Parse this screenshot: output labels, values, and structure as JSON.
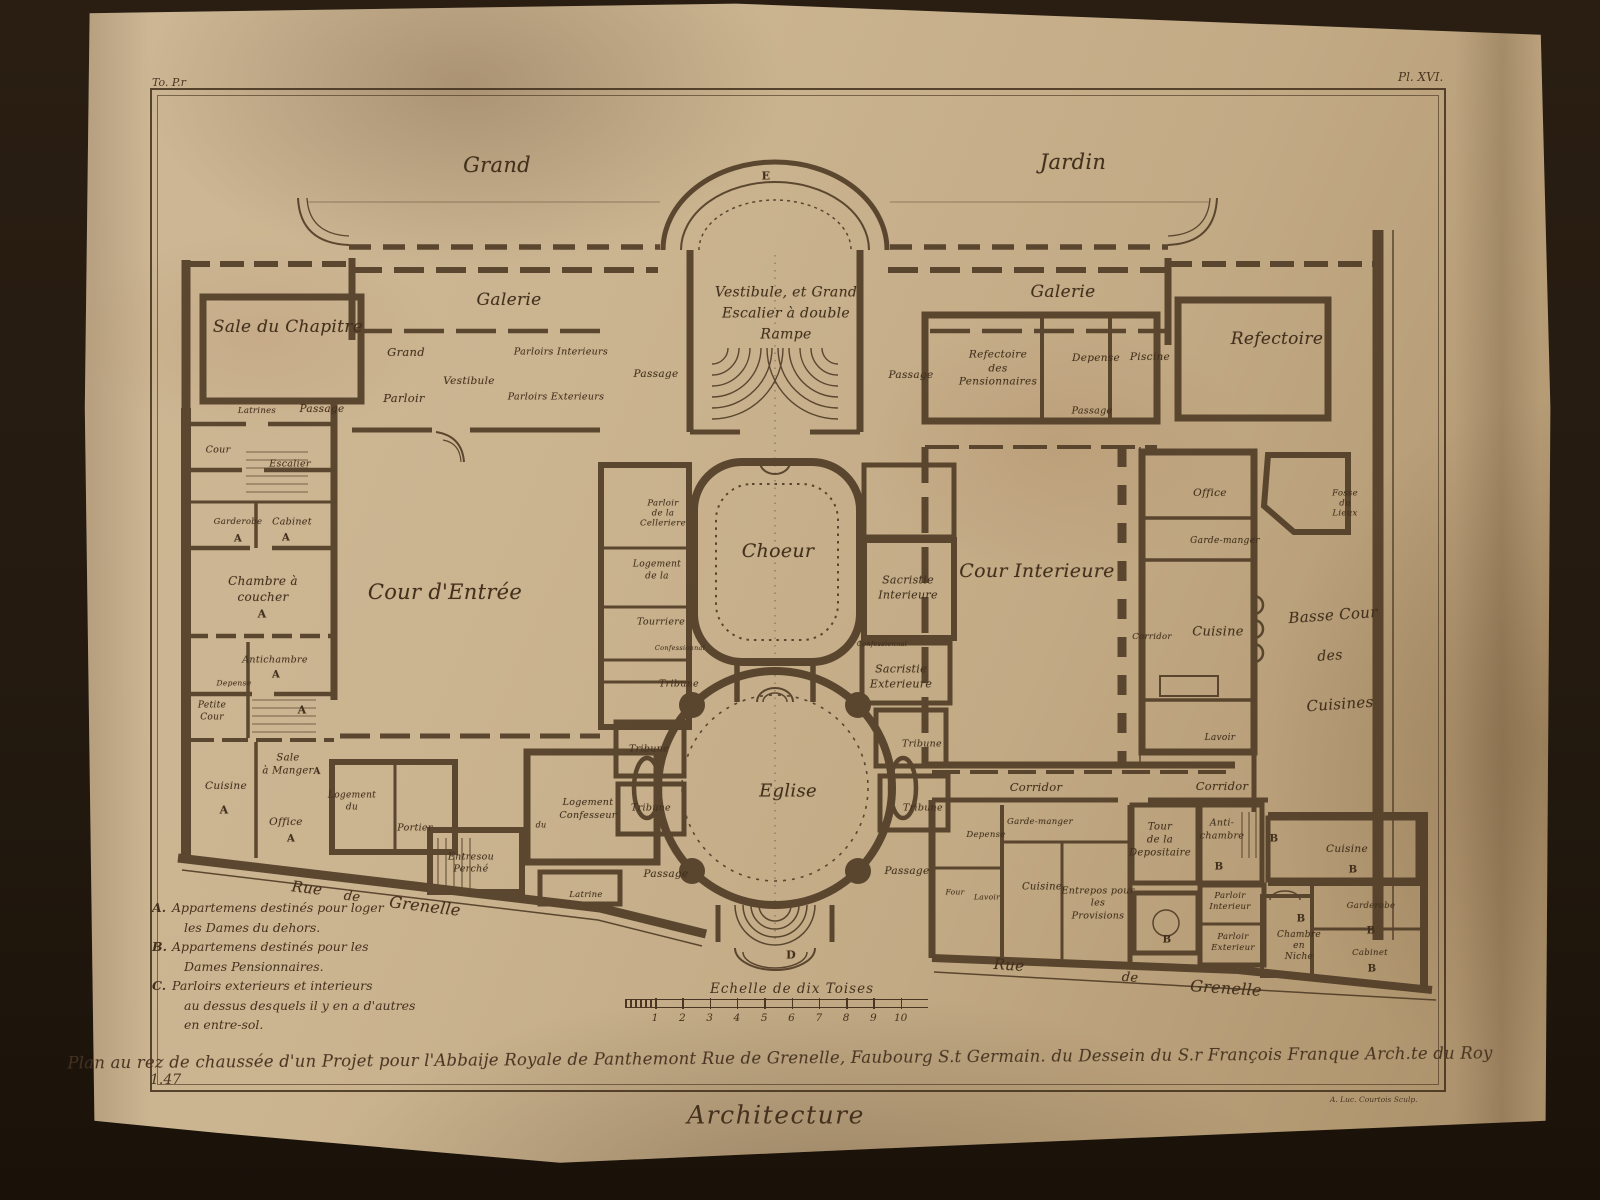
{
  "plate": {
    "tome_ref": "To. P.r",
    "plate_no": "Pl. XVI.",
    "page_no": "1.47",
    "section_title": "Architecture",
    "engraver_credit": "A. Luc. Courtois Sculp.",
    "caption": "Plan au rez de chaussée d'un Projet pour l'Abbaije Royale de Panthemont Rue de Grenelle, Faubourg S.t Germain. du Dessein du S.r François Franque Arch.te du Roy",
    "ink_color": "#4e3a25",
    "paper_color": "#c8b08c"
  },
  "scale_bar": {
    "label": "Echelle de dix Toises",
    "ticks": [
      "1",
      "2",
      "3",
      "4",
      "5",
      "6",
      "7",
      "8",
      "9",
      "10"
    ]
  },
  "legend": {
    "items": [
      {
        "key": "A.",
        "lines": [
          "Appartemens destinés pour loger",
          "les Dames du dehors."
        ]
      },
      {
        "key": "B.",
        "lines": [
          "Appartemens destinés pour les",
          "Dames Pensionnaires."
        ]
      },
      {
        "key": "C.",
        "lines": [
          "Parloirs exterieurs et interieurs",
          "au dessus desquels il y en a d'autres",
          "en entre-sol."
        ]
      }
    ]
  },
  "plan_labels": [
    {
      "text": "Grand",
      "x": 497,
      "y": 165,
      "fs": 21
    },
    {
      "text": "Jardin",
      "x": 1073,
      "y": 162,
      "fs": 21
    },
    {
      "text": "E",
      "x": 766,
      "y": 176,
      "fs": 11,
      "u": 1
    },
    {
      "text": "D",
      "x": 791,
      "y": 955,
      "fs": 11,
      "u": 1
    },
    {
      "text": "Sale du Chapitre",
      "x": 288,
      "y": 327,
      "fs": 17
    },
    {
      "text": "Galerie",
      "x": 509,
      "y": 300,
      "fs": 17
    },
    {
      "text": "Vestibule, et Grand\nEscalier à double\nRampe",
      "x": 786,
      "y": 314,
      "fs": 14,
      "lh": 1.5
    },
    {
      "text": "Galerie",
      "x": 1063,
      "y": 292,
      "fs": 17
    },
    {
      "text": "Refectoire",
      "x": 1277,
      "y": 339,
      "fs": 17
    },
    {
      "text": "Grand",
      "x": 406,
      "y": 352,
      "fs": 11.5
    },
    {
      "text": "Parloir",
      "x": 404,
      "y": 398,
      "fs": 11.5
    },
    {
      "text": "Vestibule",
      "x": 469,
      "y": 381,
      "fs": 10.5
    },
    {
      "text": "Parloirs Interieurs",
      "x": 561,
      "y": 352,
      "fs": 9.5
    },
    {
      "text": "Parloirs Exterieurs",
      "x": 556,
      "y": 397,
      "fs": 9.5
    },
    {
      "text": "Passage",
      "x": 656,
      "y": 374,
      "fs": 10.5
    },
    {
      "text": "Passage",
      "x": 911,
      "y": 375,
      "fs": 10.5
    },
    {
      "text": "Refectoire\ndes\nPensionnaires",
      "x": 998,
      "y": 369,
      "fs": 10.5,
      "lh": 1.3
    },
    {
      "text": "Depense",
      "x": 1096,
      "y": 358,
      "fs": 10.5
    },
    {
      "text": "Piscine",
      "x": 1150,
      "y": 357,
      "fs": 10.5
    },
    {
      "text": "Passage",
      "x": 1092,
      "y": 411,
      "fs": 9.5
    },
    {
      "text": "Latrines",
      "x": 257,
      "y": 411,
      "fs": 8.5
    },
    {
      "text": "Passage",
      "x": 322,
      "y": 409,
      "fs": 10.5
    },
    {
      "text": "Cour",
      "x": 218,
      "y": 450,
      "fs": 9.5
    },
    {
      "text": "Escalier",
      "x": 290,
      "y": 464,
      "fs": 9.5
    },
    {
      "text": "Garderobe",
      "x": 238,
      "y": 522,
      "fs": 8.5
    },
    {
      "text": "A",
      "x": 238,
      "y": 539,
      "fs": 10,
      "u": 1
    },
    {
      "text": "Cabinet",
      "x": 292,
      "y": 522,
      "fs": 9.5
    },
    {
      "text": "A",
      "x": 286,
      "y": 538,
      "fs": 10,
      "u": 1
    },
    {
      "text": "Chambre à\ncoucher",
      "x": 263,
      "y": 589,
      "fs": 12,
      "lh": 1.35
    },
    {
      "text": "A",
      "x": 262,
      "y": 614,
      "fs": 11,
      "u": 1
    },
    {
      "text": "Cour d'Entrée",
      "x": 445,
      "y": 592,
      "fs": 21
    },
    {
      "text": "Antichambre",
      "x": 275,
      "y": 660,
      "fs": 9.5
    },
    {
      "text": "A",
      "x": 276,
      "y": 675,
      "fs": 10,
      "u": 1
    },
    {
      "text": "Depense",
      "x": 234,
      "y": 683,
      "fs": 7.5
    },
    {
      "text": "Petite\nCour",
      "x": 212,
      "y": 712,
      "fs": 9,
      "lh": 1.3
    },
    {
      "text": "A",
      "x": 302,
      "y": 710,
      "fs": 11,
      "u": 1
    },
    {
      "text": "Sale\nà Manger",
      "x": 288,
      "y": 765,
      "fs": 10,
      "lh": 1.25
    },
    {
      "text": "A",
      "x": 317,
      "y": 772,
      "fs": 9,
      "u": 1
    },
    {
      "text": "Cuisine",
      "x": 226,
      "y": 786,
      "fs": 10.5
    },
    {
      "text": "A",
      "x": 224,
      "y": 810,
      "fs": 11,
      "u": 1
    },
    {
      "text": "Office",
      "x": 286,
      "y": 822,
      "fs": 10.5
    },
    {
      "text": "A",
      "x": 291,
      "y": 839,
      "fs": 10,
      "u": 1
    },
    {
      "text": "Parloir\nde la\nCelleriere",
      "x": 663,
      "y": 514,
      "fs": 8.5,
      "lh": 1.2
    },
    {
      "text": "Choeur",
      "x": 778,
      "y": 551,
      "fs": 19
    },
    {
      "text": "Logement\nde la",
      "x": 657,
      "y": 571,
      "fs": 9,
      "lh": 1.3
    },
    {
      "text": "Tourriere",
      "x": 661,
      "y": 622,
      "fs": 9.5
    },
    {
      "text": "Confessionnal",
      "x": 680,
      "y": 648,
      "fs": 6.5
    },
    {
      "text": "Confessionnal",
      "x": 882,
      "y": 644,
      "fs": 6.5
    },
    {
      "text": "Sacristie\nInterieure",
      "x": 908,
      "y": 588,
      "fs": 11,
      "lh": 1.4
    },
    {
      "text": "Sacristie\nExterieure",
      "x": 901,
      "y": 677,
      "fs": 11,
      "lh": 1.4
    },
    {
      "text": "Tribune",
      "x": 679,
      "y": 684,
      "fs": 9.5
    },
    {
      "text": "Tribune",
      "x": 649,
      "y": 749,
      "fs": 9.5
    },
    {
      "text": "Tribune",
      "x": 651,
      "y": 808,
      "fs": 9.5
    },
    {
      "text": "Tribune",
      "x": 922,
      "y": 744,
      "fs": 9.5
    },
    {
      "text": "Tribune",
      "x": 923,
      "y": 808,
      "fs": 9.5
    },
    {
      "text": "Eglise",
      "x": 788,
      "y": 791,
      "fs": 18
    },
    {
      "text": "Passage",
      "x": 666,
      "y": 874,
      "fs": 10.5
    },
    {
      "text": "Passage",
      "x": 907,
      "y": 871,
      "fs": 10.5
    },
    {
      "text": "Cour Interieure",
      "x": 1037,
      "y": 571,
      "fs": 19
    },
    {
      "text": "Office",
      "x": 1210,
      "y": 493,
      "fs": 10.5
    },
    {
      "text": "Garde-manger",
      "x": 1225,
      "y": 541,
      "fs": 9
    },
    {
      "text": "Fosse\ndu\nLieux",
      "x": 1345,
      "y": 504,
      "fs": 8.5,
      "lh": 1.2
    },
    {
      "text": "Corridor",
      "x": 1152,
      "y": 637,
      "fs": 8.5
    },
    {
      "text": "Cuisine",
      "x": 1218,
      "y": 632,
      "fs": 13
    },
    {
      "text": "Lavoir",
      "x": 1220,
      "y": 738,
      "fs": 9
    },
    {
      "text": "Basse Cour",
      "x": 1333,
      "y": 615,
      "fs": 15,
      "rot": -4
    },
    {
      "text": "des",
      "x": 1330,
      "y": 656,
      "fs": 14,
      "rot": -4
    },
    {
      "text": "Cuisines",
      "x": 1340,
      "y": 704,
      "fs": 15,
      "rot": -4
    },
    {
      "text": "Logement\ndu",
      "x": 352,
      "y": 802,
      "fs": 9,
      "lh": 1.3
    },
    {
      "text": "Portier",
      "x": 415,
      "y": 828,
      "fs": 9.5
    },
    {
      "text": "Entresou\nPerché",
      "x": 471,
      "y": 864,
      "fs": 9.5,
      "lh": 1.3
    },
    {
      "text": "Logement\nConfesseur",
      "x": 588,
      "y": 810,
      "fs": 9.5,
      "lh": 1.35
    },
    {
      "text": "du",
      "x": 541,
      "y": 825,
      "fs": 8
    },
    {
      "text": "Latrine",
      "x": 586,
      "y": 895,
      "fs": 8.5
    },
    {
      "text": "Rue",
      "x": 307,
      "y": 888,
      "fs": 15,
      "rot": 7
    },
    {
      "text": "de",
      "x": 352,
      "y": 897,
      "fs": 13,
      "rot": 7
    },
    {
      "text": "Grenelle",
      "x": 425,
      "y": 906,
      "fs": 16,
      "rot": 7
    },
    {
      "text": "Corridor",
      "x": 1036,
      "y": 787,
      "fs": 11.5
    },
    {
      "text": "Corridor",
      "x": 1222,
      "y": 786,
      "fs": 11.5
    },
    {
      "text": "Garde-manger",
      "x": 1040,
      "y": 822,
      "fs": 8.5
    },
    {
      "text": "Depense",
      "x": 986,
      "y": 835,
      "fs": 8.5
    },
    {
      "text": "Four",
      "x": 955,
      "y": 892,
      "fs": 7.5
    },
    {
      "text": "Lavoir",
      "x": 987,
      "y": 897,
      "fs": 7.5
    },
    {
      "text": "Cuisine",
      "x": 1042,
      "y": 887,
      "fs": 10
    },
    {
      "text": "Entrepos pour\nles\nProvisions",
      "x": 1098,
      "y": 904,
      "fs": 9.5,
      "lh": 1.3
    },
    {
      "text": "Tour\nde la\nDepositaire",
      "x": 1160,
      "y": 840,
      "fs": 10,
      "lh": 1.3
    },
    {
      "text": "Anti-\nchambre",
      "x": 1222,
      "y": 830,
      "fs": 9.5,
      "lh": 1.4
    },
    {
      "text": "B",
      "x": 1274,
      "y": 839,
      "fs": 10,
      "u": 1
    },
    {
      "text": "B",
      "x": 1219,
      "y": 867,
      "fs": 10,
      "u": 1
    },
    {
      "text": "B",
      "x": 1167,
      "y": 940,
      "fs": 10,
      "u": 1
    },
    {
      "text": "Parloir\nInterieur",
      "x": 1230,
      "y": 902,
      "fs": 8.5,
      "lh": 1.3
    },
    {
      "text": "Parloir\nExterieur",
      "x": 1233,
      "y": 943,
      "fs": 8.5,
      "lh": 1.3
    },
    {
      "text": "Rue",
      "x": 1009,
      "y": 965,
      "fs": 15,
      "rot": 4
    },
    {
      "text": "de",
      "x": 1130,
      "y": 978,
      "fs": 13,
      "rot": 4
    },
    {
      "text": "Grenelle",
      "x": 1226,
      "y": 988,
      "fs": 16,
      "rot": 4
    },
    {
      "text": "Cuisine",
      "x": 1347,
      "y": 849,
      "fs": 10.5
    },
    {
      "text": "B",
      "x": 1353,
      "y": 870,
      "fs": 10,
      "u": 1
    },
    {
      "text": "Garderobe",
      "x": 1371,
      "y": 906,
      "fs": 8.5
    },
    {
      "text": "B",
      "x": 1371,
      "y": 931,
      "fs": 10,
      "u": 1
    },
    {
      "text": "B",
      "x": 1301,
      "y": 919,
      "fs": 10,
      "u": 1
    },
    {
      "text": "Chambre\nen\nNiche",
      "x": 1299,
      "y": 946,
      "fs": 9,
      "lh": 1.2
    },
    {
      "text": "Cabinet",
      "x": 1370,
      "y": 953,
      "fs": 8.5
    },
    {
      "text": "B",
      "x": 1372,
      "y": 969,
      "fs": 10,
      "u": 1
    }
  ]
}
